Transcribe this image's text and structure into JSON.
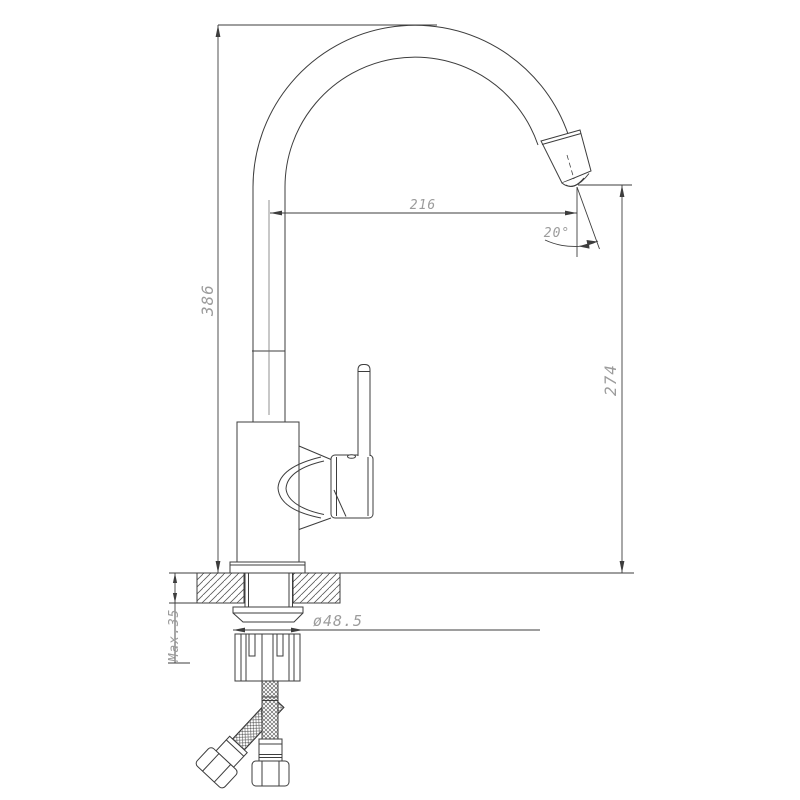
{
  "drawing": {
    "subject": "kitchen-faucet-dimension-drawing",
    "background": "#ffffff",
    "line_color": "#3d3d3d",
    "dim_text_color": "#9c9c9c",
    "labels": {
      "overall_height": "386",
      "spout_reach": "216",
      "outlet_height": "274",
      "outlet_angle": "20°",
      "shank_diameter": "ø48.5",
      "max_counter_thickness": "Max.35"
    }
  }
}
